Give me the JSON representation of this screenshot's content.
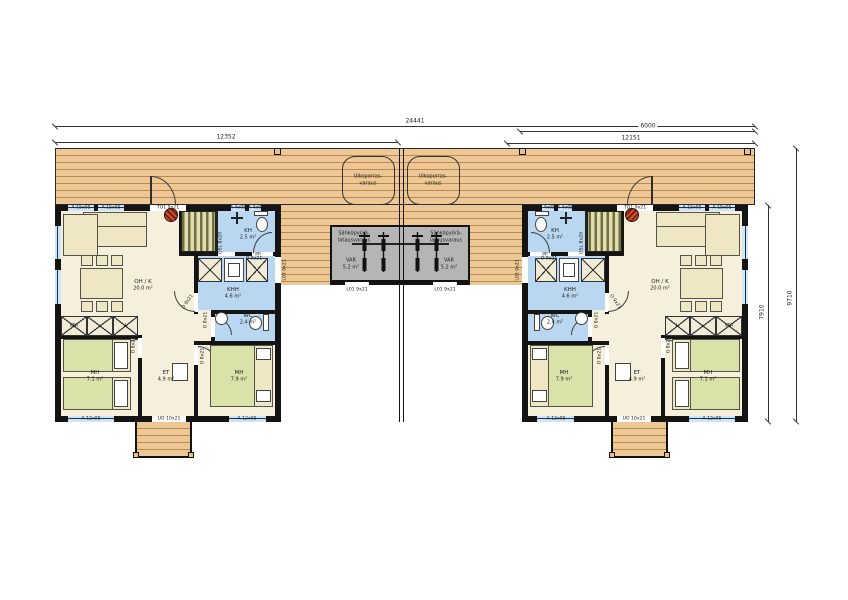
{
  "dimensions": {
    "total_width": "24441",
    "left_section": "12352",
    "right_deck": "6000",
    "right_section": "12151",
    "house_depth": "7910",
    "total_depth": "9710"
  },
  "deck": {
    "stair_reservation_line1": "Ulkoporras-",
    "stair_reservation_line2": "varaus"
  },
  "storage": {
    "name_line1": "Sähköpyörä-",
    "name_line2": "latausvaraus",
    "label": "VAR",
    "area": "5.2 m²",
    "door_code": "L01 9x21"
  },
  "rooms": {
    "ohk": {
      "name": "OH / K",
      "area": "20.0 m²"
    },
    "khh": {
      "name": "KHH",
      "area": "4.6 m²"
    },
    "kh": {
      "name": "KH",
      "area": "2.5 m²"
    },
    "wc": {
      "name": "WC",
      "area": "2.4 m²"
    },
    "et": {
      "name": "ET",
      "area": "4.9 m²"
    },
    "mh1": {
      "name": "MH",
      "area": "7.1 m²"
    },
    "mh2": {
      "name": "MH",
      "area": "7.9 m²"
    }
  },
  "codes": {
    "entry_door": "UO 10x21",
    "terrace_door": "TO1 9x21",
    "side_door": "L03 9x21",
    "sliding_door": "OSL 8x20",
    "door_9": "O 9x21",
    "door_8": "O 8x21",
    "window_a15": "A 15x05",
    "window_a4": "A 4x05",
    "window_a12": "A 12x05",
    "closet_vpa": "VPA",
    "closet_l": "L",
    "appliance_pk": "PK",
    "appliance_pp": "PP"
  }
}
